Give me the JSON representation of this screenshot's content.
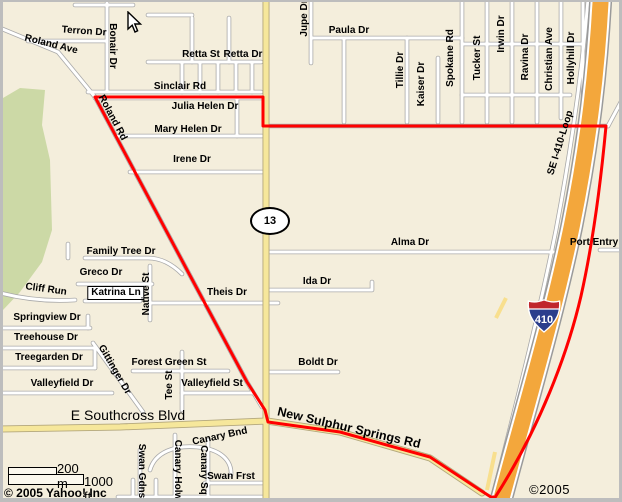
{
  "map": {
    "attribution_left": "© 2005 Yahoo! Inc",
    "attribution_right": "©2005 NAVTEQ",
    "scale": {
      "metric": "200 m",
      "imperial": "1000 ft"
    },
    "shields": {
      "state_route": "13",
      "interstate": "410"
    },
    "cursor": {
      "x": 127,
      "y": 11
    },
    "colors": {
      "background": "#F4EEDC",
      "park_green": "#CCD9A6",
      "road_white": "#FFFFFF",
      "road_casing": "#A9A9A9",
      "road_yellow": "#F6E79B",
      "yellow_casing": "#B3A77C",
      "highway_orange": "#F3A73C",
      "route_red": "#FF0000",
      "frame_gray": "#BDBDBD",
      "shield_blue": "#2B3E8C",
      "shield_red": "#C0272D"
    },
    "street_labels": [
      {
        "text": "Roland Ave",
        "x": 51,
        "y": 45,
        "rot": 14
      },
      {
        "text": "Terron Dr",
        "x": 84,
        "y": 32,
        "rot": 4
      },
      {
        "text": "Bonair Dr",
        "x": 112,
        "y": 46,
        "rot": 90
      },
      {
        "text": "Roland Rd",
        "x": 112,
        "y": 118,
        "rot": 62
      },
      {
        "text": "Retta St",
        "x": 201,
        "y": 55,
        "rot": 0
      },
      {
        "text": "Retta Dr",
        "x": 243,
        "y": 55,
        "rot": 0
      },
      {
        "text": "Sinclair Rd",
        "x": 180,
        "y": 87,
        "rot": 0
      },
      {
        "text": "Julia Helen Dr",
        "x": 205,
        "y": 107,
        "rot": 0
      },
      {
        "text": "Mary Helen Dr",
        "x": 188,
        "y": 130,
        "rot": 0
      },
      {
        "text": "Irene Dr",
        "x": 192,
        "y": 160,
        "rot": 0
      },
      {
        "text": "Jupe Dr",
        "x": 305,
        "y": 18,
        "rot": -90
      },
      {
        "text": "Paula Dr",
        "x": 349,
        "y": 31,
        "rot": 0
      },
      {
        "text": "Tillie Dr",
        "x": 401,
        "y": 70,
        "rot": -90
      },
      {
        "text": "Kaiser Dr",
        "x": 422,
        "y": 84,
        "rot": -90
      },
      {
        "text": "Spokane Rd",
        "x": 451,
        "y": 58,
        "rot": -90
      },
      {
        "text": "Tucker St",
        "x": 478,
        "y": 58,
        "rot": -90
      },
      {
        "text": "Irwin Dr",
        "x": 502,
        "y": 34,
        "rot": -90
      },
      {
        "text": "Ravina Dr",
        "x": 526,
        "y": 57,
        "rot": -90
      },
      {
        "text": "Christian Ave",
        "x": 550,
        "y": 59,
        "rot": -90
      },
      {
        "text": "Hollyhill Dr",
        "x": 572,
        "y": 58,
        "rot": -90
      },
      {
        "text": "SE I-410-Loop",
        "x": 561,
        "y": 143,
        "rot": -73
      },
      {
        "text": "Alma Dr",
        "x": 410,
        "y": 243,
        "rot": 0
      },
      {
        "text": "Port Entry",
        "x": 594,
        "y": 243,
        "rot": 0
      },
      {
        "text": "Ida Dr",
        "x": 317,
        "y": 282,
        "rot": 0
      },
      {
        "text": "Theis Dr",
        "x": 227,
        "y": 293,
        "rot": 0
      },
      {
        "text": "Family Tree Dr",
        "x": 121,
        "y": 252,
        "rot": 0
      },
      {
        "text": "Greco Dr",
        "x": 101,
        "y": 273,
        "rot": 0
      },
      {
        "text": "Cliff Run",
        "x": 46,
        "y": 290,
        "rot": 8
      },
      {
        "text": "Katrina Ln",
        "x": 116,
        "y": 293,
        "rot": 0,
        "boxed": true
      },
      {
        "text": "Native St",
        "x": 147,
        "y": 294,
        "rot": -90
      },
      {
        "text": "Springview Dr",
        "x": 47,
        "y": 318,
        "rot": 0
      },
      {
        "text": "Treehouse Dr",
        "x": 46,
        "y": 338,
        "rot": 0
      },
      {
        "text": "Treegarden Dr",
        "x": 49,
        "y": 358,
        "rot": 0
      },
      {
        "text": "Gittinger Dr",
        "x": 114,
        "y": 370,
        "rot": 60
      },
      {
        "text": "Forest Green St",
        "x": 169,
        "y": 363,
        "rot": 0
      },
      {
        "text": "Valleyfield Dr",
        "x": 62,
        "y": 384,
        "rot": 0
      },
      {
        "text": "Tee St",
        "x": 170,
        "y": 385,
        "rot": -90
      },
      {
        "text": "Valleyfield St",
        "x": 212,
        "y": 384,
        "rot": 0
      },
      {
        "text": "E Southcross Blvd",
        "x": 128,
        "y": 415,
        "rot": 0,
        "size": 14,
        "weight": "normal"
      },
      {
        "text": "Boldt Dr",
        "x": 318,
        "y": 363,
        "rot": 0
      },
      {
        "text": "New Sulphur Springs Rd",
        "x": 349,
        "y": 428,
        "rot": 13,
        "size": 12.5
      },
      {
        "text": "Canary Bnd",
        "x": 220,
        "y": 437,
        "rot": -12
      },
      {
        "text": "Swan Gdns",
        "x": 141,
        "y": 471,
        "rot": 90
      },
      {
        "text": "Canary Holw",
        "x": 177,
        "y": 470,
        "rot": 90
      },
      {
        "text": "Canary Sq",
        "x": 203,
        "y": 470,
        "rot": 90
      },
      {
        "text": "Swan Frst",
        "x": 231,
        "y": 477,
        "rot": 0
      }
    ]
  }
}
